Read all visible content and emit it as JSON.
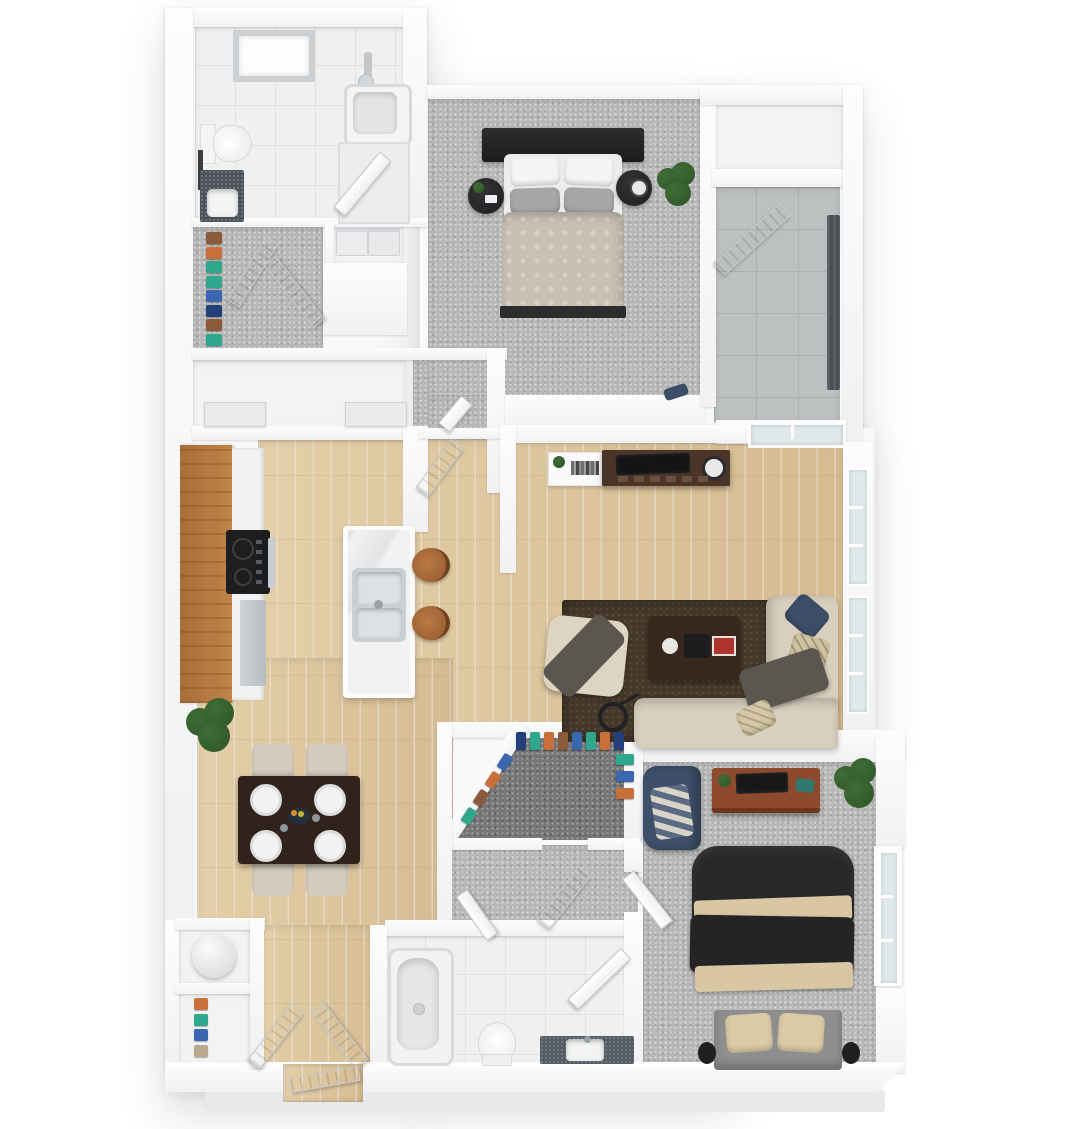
{
  "scene": {
    "type": "3d-floorplan-top-view-render",
    "description": "Two-bedroom two-bath apartment 3D floor plan, no text labels visible",
    "background": "#ffffff"
  },
  "palette": {
    "wall": "#f9f9fa",
    "tile": "#f0f0f1",
    "tileLine": "#e1e1e3",
    "patioTile": "#bcc0c1",
    "patioTileLine": "#acb0b1",
    "carpet": "#b7b7b8",
    "carpetDark": "#77777a",
    "wood": "#dcc49e",
    "cabinetWood": "#b0763f",
    "marble": "#f2f2f0",
    "stainless": "#c7cdd2",
    "cooktop": "#1d1e20",
    "rug": "#46392a",
    "sofa": "#d8cfbe",
    "throwDark": "#5b5750",
    "navy": "#3c4e67",
    "beigePillow": "#d3c7a8",
    "console": "#4b3428",
    "diningTable": "#30231b",
    "chairBeige": "#d4cdbf",
    "bedHeadboard": "#222324",
    "duvetBeige": "#c8c1b2",
    "pillowGray": "#a7a7a9",
    "duvetBlack": "#28282b",
    "bedAccent": "#d8c7a2",
    "platformGray": "#8e8e90",
    "deskWood": "#8d4a2c",
    "vanityDark": "#555c64",
    "plant": "#3f6d35",
    "plantDark": "#2d5527",
    "glass": "#dfe9ea",
    "curtain": "#54575a",
    "ground": "#e9e9ec"
  },
  "rooms": [
    {
      "id": "bathroom-1",
      "floor": "white-tile",
      "features": [
        "skylight",
        "toilet",
        "vanity",
        "bathtub",
        "shower-stall",
        "mirror"
      ]
    },
    {
      "id": "walk-in-closet-1",
      "floor": "carpet",
      "features": [
        "clothes-rail",
        "bifold-louver-doors"
      ]
    },
    {
      "id": "laundry-nook",
      "floor": "white",
      "features": [
        "washer",
        "dryer"
      ]
    },
    {
      "id": "linen-room",
      "floor": "white",
      "features": [
        "cabinet",
        "cabinet"
      ]
    },
    {
      "id": "bedroom-1",
      "floor": "carpet",
      "features": [
        "queen-bed",
        "headboard",
        "nightstand-left",
        "nightstand-right",
        "potted-plant"
      ]
    },
    {
      "id": "patio-closet",
      "floor": "white",
      "features": []
    },
    {
      "id": "patio",
      "floor": "gray-tile",
      "features": [
        "louver-door",
        "dark-curtain",
        "sliding-glass-door"
      ]
    },
    {
      "id": "kitchen",
      "floor": "wood",
      "features": [
        "cabinet-run",
        "counter",
        "cooktop",
        "dishwasher",
        "island-with-sink",
        "barstool",
        "barstool"
      ]
    },
    {
      "id": "living-room",
      "floor": "wood",
      "features": [
        "media-console-tv",
        "white-shelf",
        "area-rug",
        "coffee-table",
        "sectional-sofa",
        "pouf",
        "floor-lamp",
        "windows"
      ]
    },
    {
      "id": "dining-area",
      "floor": "wood",
      "features": [
        "dining-table",
        "4-place-settings",
        "4-chairs",
        "potted-plant"
      ]
    },
    {
      "id": "walk-in-closet-2",
      "floor": "dark-carpet",
      "features": [
        "diagonal-wall",
        "clothes-rail"
      ]
    },
    {
      "id": "hallway",
      "floor": "carpet",
      "features": [
        "louver-door",
        "door"
      ]
    },
    {
      "id": "bathroom-2",
      "floor": "white-tile",
      "features": [
        "bathtub",
        "toilet",
        "vanity",
        "shower-door"
      ]
    },
    {
      "id": "bedroom-2",
      "floor": "carpet",
      "features": [
        "bed-dark-duvet",
        "accent-chair",
        "desk-with-monitor",
        "potted-plant",
        "window",
        "side-tables"
      ]
    },
    {
      "id": "water-heater-closet",
      "floor": "white",
      "features": [
        "water-heater-tank"
      ]
    },
    {
      "id": "coat-closet",
      "floor": "white",
      "features": [
        "clothes-rail"
      ]
    },
    {
      "id": "entry",
      "floor": "wood",
      "features": [
        "double-doors",
        "front-door"
      ]
    }
  ],
  "clothes": {
    "walkin_a": [
      "#8a5a3a",
      "#c96f3a",
      "#2fa78c",
      "#2fa78c",
      "#3b66b0",
      "#24407a",
      "#8a5a3a",
      "#2fa78c"
    ],
    "walkin_b_top": [
      "#24407a",
      "#2fa78c",
      "#c96f3a",
      "#8a5a3a",
      "#3b66b0",
      "#2fa78c",
      "#c96f3a",
      "#24407a"
    ],
    "walkin_b_side": [
      "#2fa78c",
      "#3b66b0",
      "#c96f3a"
    ],
    "walkin_b_diag": [
      "#2fa78c",
      "#8a5a3a",
      "#c96f3a",
      "#3b66b0"
    ],
    "coat": [
      "#c96f3a",
      "#2fa78c",
      "#3b66b0",
      "#b8a98f"
    ]
  }
}
